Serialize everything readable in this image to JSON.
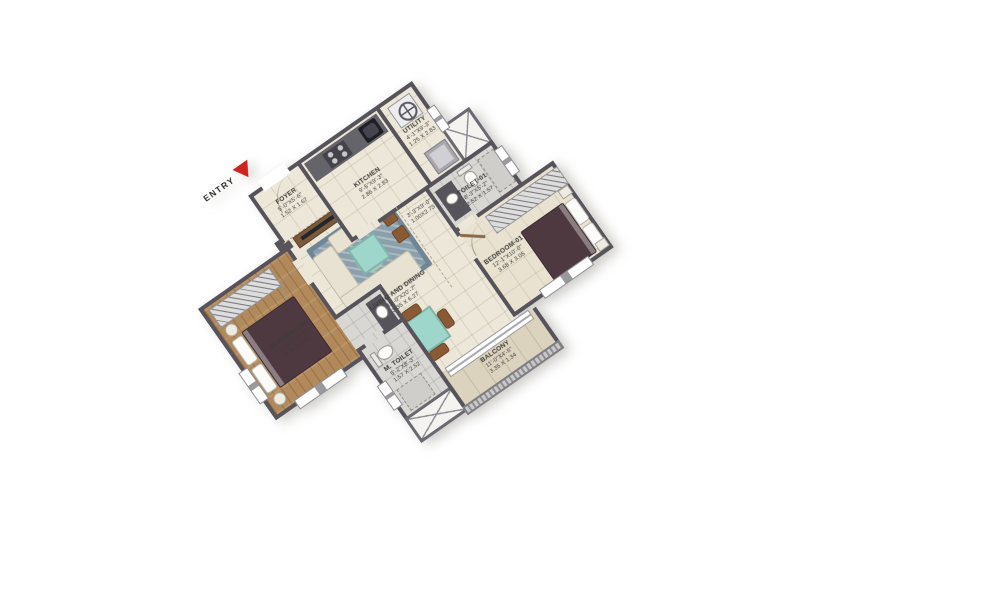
{
  "plan": {
    "entry_label": "ENTRY",
    "rooms": {
      "foyer": {
        "name": "FOYER",
        "dims_ft": "5'-0\"X5'-6\"",
        "dims_m": "1.52 X 1.67"
      },
      "kitchen": {
        "name": "KITCHEN",
        "dims_ft": "9'-5\"X9'-3\"",
        "dims_m": "2.86 X 2.83"
      },
      "utility": {
        "name": "UTILITY",
        "dims_ft": "4'-1\"X9'-3\"",
        "dims_m": "1.25 X 2.83"
      },
      "passage": {
        "dims_ft": "3'-3\"X9'-0\"",
        "dims_m": "1.00X2.73"
      },
      "toilet01": {
        "name": "TOILET-01",
        "dims_ft": "8'-3\"X5'-2\"",
        "dims_m": "2.52 X 1.57"
      },
      "living": {
        "name": "LIVING AND DINING",
        "dims_ft": "11'-0\"X20'-7\"",
        "dims_m": "3.35 X 6.27"
      },
      "mbedroom": {
        "name": "M.BEDROOM",
        "dims_ft": "11'-0\"X13'-0\"",
        "dims_m": "3.35 X 3.95"
      },
      "mtoilet": {
        "name": "M. TOILET",
        "dims_ft": "5'-2\"X8'-3\"",
        "dims_m": "1.57 X 2.52"
      },
      "balcony": {
        "name": "BALCONY",
        "dims_ft": "11'-0\"X4'-5\"",
        "dims_m": "3.35 X 1.34"
      },
      "bedroom01": {
        "name": "BEDROOM-01",
        "dims_ft": "12'-1\"X10'-0\"",
        "dims_m": "3.68 X 3.05"
      }
    },
    "colors": {
      "wall": "#56535B",
      "entry_arrow_red": "#CF231D",
      "tile_floor": "#ECE7D8",
      "wood_floor": "#B1895A",
      "bath_floor": "#D8D7D3",
      "table_teal": "#9FD6CB",
      "duvet_maroon": "#4E3940",
      "chair_brown": "#8A5A35"
    }
  }
}
